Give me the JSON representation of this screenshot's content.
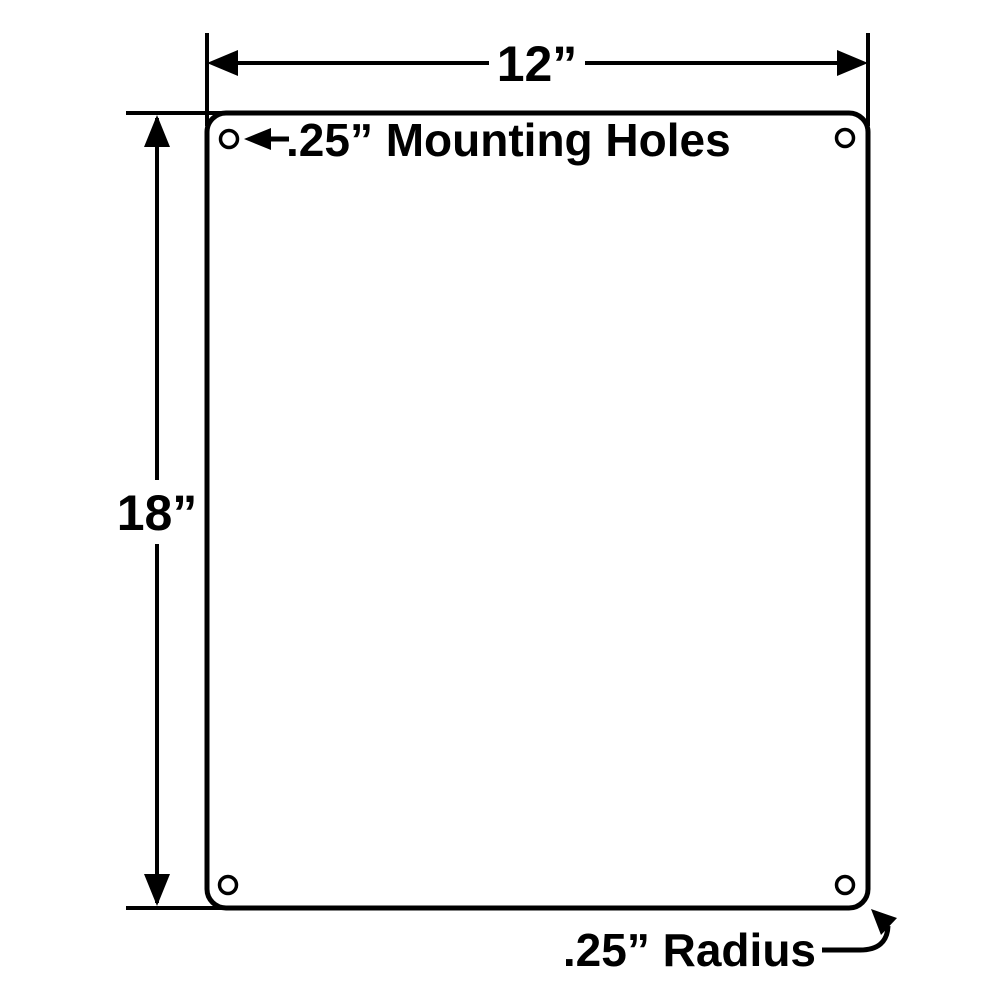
{
  "diagram": {
    "type": "technical-dimension-drawing",
    "subject": "rectangular panel blank with rounded corners and four corner mounting holes",
    "width_dimension": {
      "label": "12”",
      "value_inches": 12
    },
    "height_dimension": {
      "label": "18”",
      "value_inches": 18
    },
    "mounting_holes": {
      "label": ".25” Mounting Holes",
      "diameter_inches": 0.25,
      "count": 4
    },
    "corner_radius": {
      "label": ".25” Radius",
      "value_inches": 0.25
    }
  },
  "colors": {
    "line": "#000000",
    "background": "#ffffff"
  }
}
